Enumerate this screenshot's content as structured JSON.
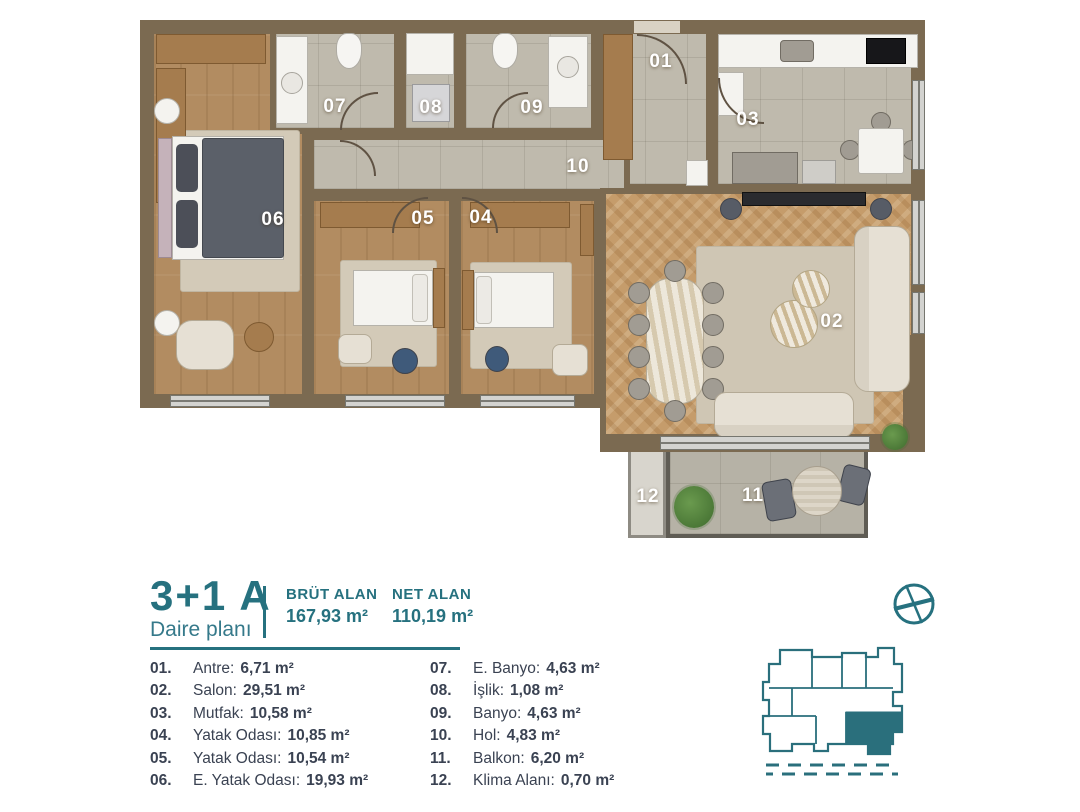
{
  "header": {
    "title": "3+1 A",
    "subtitle": "Daire planı",
    "brut_label": "BRÜT ALAN",
    "brut_value": "167,93 m²",
    "net_label": "NET ALAN",
    "net_value": "110,19 m²"
  },
  "rooms": [
    {
      "plan": "01",
      "num": "01.",
      "name": "Antre:",
      "area": "6,71 m²"
    },
    {
      "plan": "02",
      "num": "02.",
      "name": "Salon:",
      "area": "29,51 m²"
    },
    {
      "plan": "03",
      "num": "03.",
      "name": "Mutfak:",
      "area": "10,58 m²"
    },
    {
      "plan": "04",
      "num": "04.",
      "name": "Yatak Odası:",
      "area": "10,85 m²"
    },
    {
      "plan": "05",
      "num": "05.",
      "name": "Yatak Odası:",
      "area": "10,54 m²"
    },
    {
      "plan": "06",
      "num": "06.",
      "name": "E. Yatak Odası:",
      "area": "19,93 m²"
    },
    {
      "plan": "07",
      "num": "07.",
      "name": "E. Banyo:",
      "area": "4,63 m²"
    },
    {
      "plan": "08",
      "num": "08.",
      "name": "İşlik:",
      "area": "1,08 m²"
    },
    {
      "plan": "09",
      "num": "09.",
      "name": "Banyo:",
      "area": "4,63 m²"
    },
    {
      "plan": "10",
      "num": "10.",
      "name": "Hol:",
      "area": "4,83 m²"
    },
    {
      "plan": "11",
      "num": "11.",
      "name": "Balkon:",
      "area": "6,20 m²"
    },
    {
      "plan": "12",
      "num": "12.",
      "name": "Klima Alanı:",
      "area": "0,70 m²"
    }
  ],
  "icons": {
    "compass": "crossed-circle-compass",
    "keyplan": "building-footprint-with-highlighted-unit"
  },
  "colors": {
    "accent_teal": "#26717f",
    "legend_text": "#3a4252",
    "wall_brown": "#7b6a51",
    "wood_floor": "#b28c61",
    "herringbone_floor": "#c59c6b",
    "tile_floor": "#bfbaad",
    "balcony_floor": "#b6b2a6",
    "plan_label": "#ffffff"
  }
}
